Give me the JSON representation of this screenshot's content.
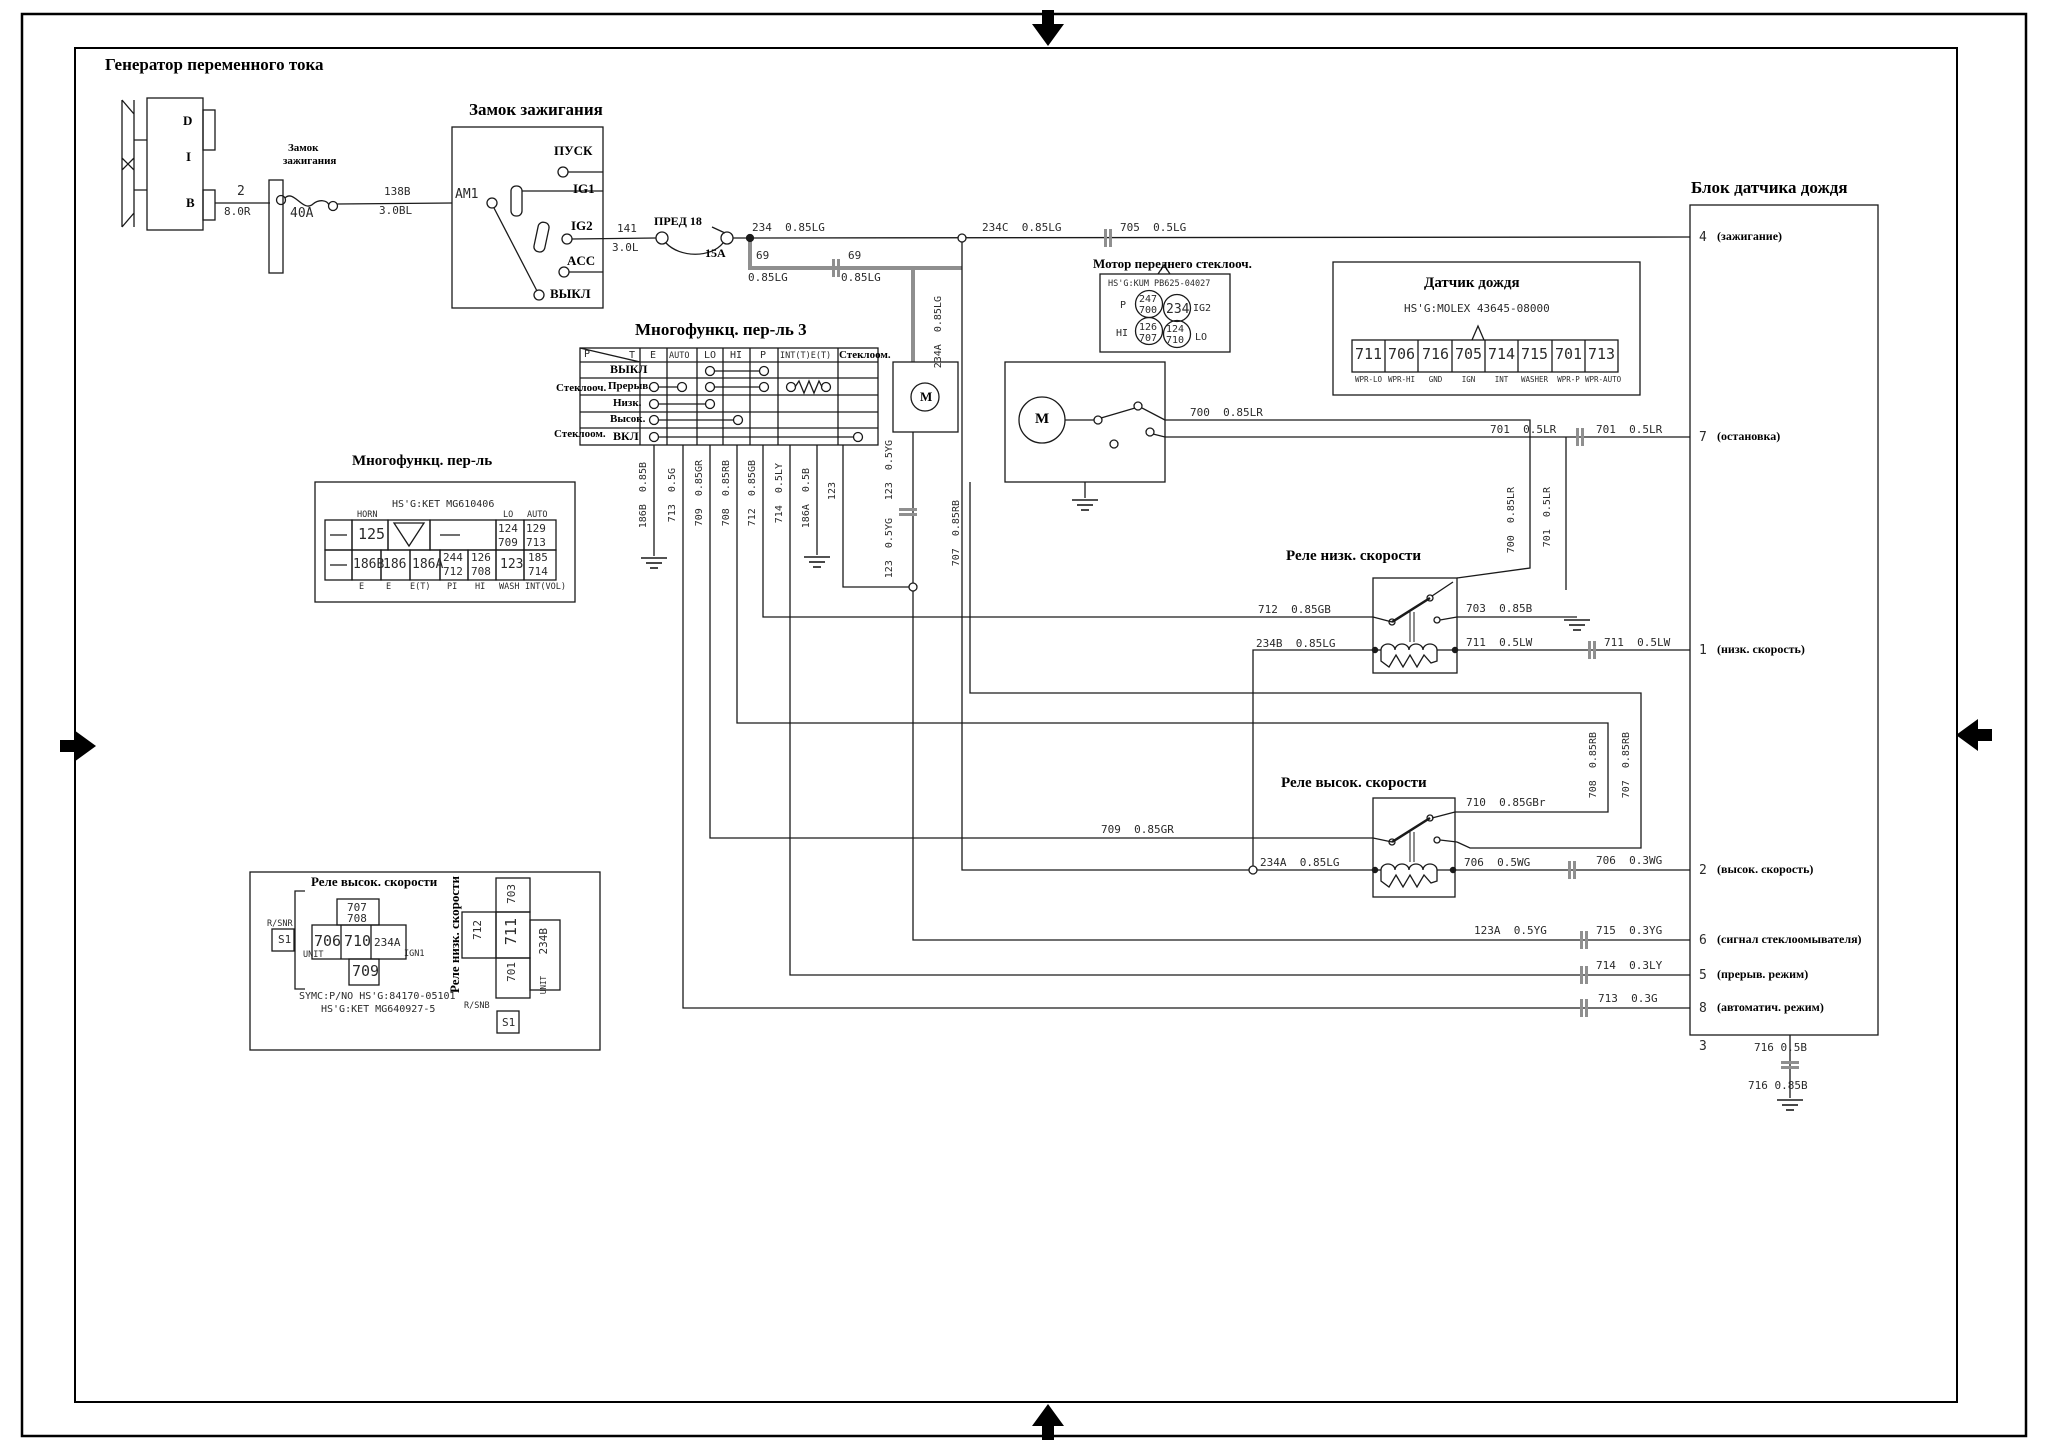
{
  "colors": {
    "line": "#1a1a1a",
    "thick_wire": "#8f8f8f",
    "bg": "#ffffff"
  },
  "titles": {
    "generator": "Генератор переменного тока",
    "ignition": "Замок зажигания",
    "mfs3": "Многофункц. пер-ль 3",
    "mfs": "Многофункц. пер-ль",
    "motor": "Мотор переднего стеклооч.",
    "rain": "Датчик дождя",
    "block": "Блок датчика дождя",
    "relay_low": "Реле низк. скорости",
    "relay_high": "Реле высок. скорости"
  },
  "generator": {
    "d": "D",
    "i": "I",
    "b": "B",
    "pin": "2",
    "wire": "8.0R",
    "fuse": "40A",
    "fl1": "Замок",
    "fl2": "зажигания",
    "w138": "138B",
    "w138g": "3.0BL"
  },
  "ignition": {
    "am1": "AM1",
    "pusk": "ПУСК",
    "ig1": "IG1",
    "ig2": "IG2",
    "acc": "ACC",
    "off": "ВЫКЛ",
    "w141": "141",
    "w141g": "3.0L",
    "fuse": "ПРЕД 18",
    "amp": "15A"
  },
  "top": {
    "w234": "234  0.85LG",
    "w234c": "234C  0.85LG",
    "w705": "705  0.5LG",
    "w69": "69",
    "w69g": "0.85LG",
    "w69b": "69",
    "w69bg": "0.85LG"
  },
  "mfs3": {
    "p": "P",
    "t": "T",
    "e": "E",
    "auto": "AUTO",
    "lo": "LO",
    "hi": "HI",
    "p2": "P",
    "intt": "INT(T)E(T)",
    "om": "Стеклоом.",
    "grp1": "Стеклооч.",
    "r1": "ВЫКЛ",
    "r2": "Прерыв.",
    "r3": "Низк.",
    "r4": "Высок.",
    "grp2": "Стеклоом.",
    "r5": "ВКЛ"
  },
  "mfs": {
    "hsg": "HS'G:KET MG610406",
    "horn": "HORN",
    "lo": "LO",
    "auto": "AUTO",
    "v125": "125",
    "v124": "124",
    "v129": "129",
    "v709": "709",
    "v713": "713",
    "v186b": "186B",
    "v186": "186",
    "v186a": "186A",
    "v244": "244",
    "v712": "712",
    "v126": "126",
    "v708": "708",
    "v123": "123",
    "v185": "185",
    "v714": "714",
    "e1": "E",
    "e2": "E",
    "e3": "E(T)",
    "e4": "PI",
    "e5": "HI",
    "e6": "WASH",
    "e7": "INT(VOL)"
  },
  "motorconn": {
    "hsg": "HS'G:KUM PB625-04027",
    "p": "P",
    "ig2": "IG2",
    "hi": "HI",
    "lo": "LO",
    "v247": "247",
    "v700": "700",
    "v234": "234",
    "v126": "126",
    "v707": "707",
    "v124": "124",
    "v710": "710"
  },
  "rain": {
    "hsg": "HS'G:MOLEX 43645-08000",
    "pins": [
      "711",
      "706",
      "716",
      "705",
      "714",
      "715",
      "701",
      "713"
    ],
    "labels": [
      "WPR-LO",
      "WPR-HI",
      "GND",
      "IGN",
      "INT",
      "WASHER",
      "WPR-P",
      "WPR-AUTO"
    ]
  },
  "vw": {
    "w186b": "186B  0.85B",
    "w713": "713  0.5G",
    "w709": "709  0.85GR",
    "w708": "708  0.85RB",
    "w712": "712  0.85GB",
    "w714": "714  0.5LY",
    "w186a": "186A  0.5B",
    "w123": "123",
    "w123y1": "123  0.5YG",
    "w123y2": "123  0.5YG",
    "w234a": "234A  0.85LG",
    "w700": "700  0.85LR",
    "w701": "701  0.5LR",
    "w707a": "707  0.85RB",
    "w708b": "708  0.85RB",
    "w707b": "707  0.85RB"
  },
  "rw": {
    "w700": "700  0.85LR",
    "w701a": "701  0.5LR",
    "w701b": "701  0.5LR",
    "w712": "712  0.85GB",
    "w703": "703  0.85B",
    "w234b": "234B  0.85LG",
    "w711a": "711  0.5LW",
    "w711b": "711  0.5LW",
    "w709": "709  0.85GR",
    "w710": "710  0.85GBr",
    "w234a": "234A  0.85LG",
    "w706a": "706  0.5WG",
    "w706b": "706  0.3WG",
    "w123a": "123A  0.5YG",
    "w715": "715  0.3YG",
    "w714": "714  0.3LY",
    "w713": "713  0.3G"
  },
  "block": {
    "pins": [
      {
        "n": "4",
        "l": "(зажигание)"
      },
      {
        "n": "7",
        "l": "(остановка)"
      },
      {
        "n": "1",
        "l": "(низк. скорость)"
      },
      {
        "n": "2",
        "l": "(высок. скорость)"
      },
      {
        "n": "6",
        "l": "(сигнал стеклоомывателя)"
      },
      {
        "n": "5",
        "l": "(прерыв. режим)"
      },
      {
        "n": "8",
        "l": "(автоматич. режим)"
      }
    ],
    "p3": "3",
    "w716a": "716 0.5B",
    "w716b": "716 0.85B"
  },
  "ch": {
    "rsnr": "R/SNR",
    "s1": "S1",
    "v707": "707",
    "v708": "708",
    "v706": "706",
    "v710": "710",
    "v234a": "234A",
    "v709": "709",
    "unit": "UNIT",
    "ign1": "IGN1",
    "sym1": "SYMC:P/NO HS'G:84170-05101",
    "sym2": "HS'G:KET MG640927-5"
  },
  "cl": {
    "rsnb": "R/SNB",
    "s1": "S1",
    "v703": "703",
    "v711": "711",
    "v712": "712",
    "v701": "701",
    "v234b": "234B",
    "unit": "UNIT"
  },
  "m1": "M",
  "m2": "M"
}
